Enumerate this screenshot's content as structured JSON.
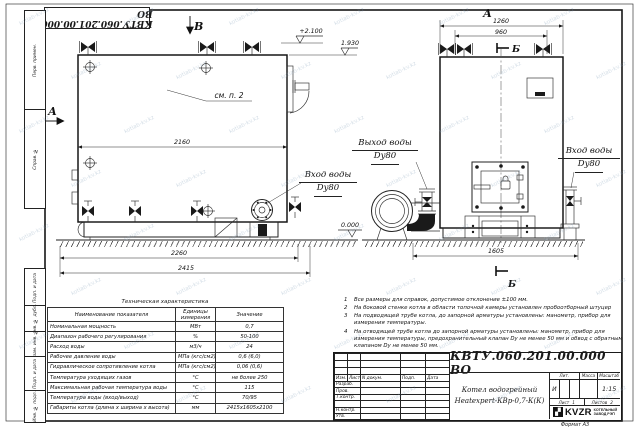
{
  "watermark": "kotlab-kv.kz",
  "corner_stamp": "КВТУ.060.201.00.000 ВО",
  "margin_labels": [
    "Перв. примен.",
    "Справ. №",
    "Подп. и дата",
    "Инв. № дубл.",
    "Взам. инв. №",
    "Подп. и дата",
    "Инв. № подл."
  ],
  "drawing": {
    "view_a_left": "А",
    "view_a_top": "А",
    "view_b": "В",
    "section_b_top": "Б",
    "section_b_bottom": "Б",
    "see_note": "см. п. 2",
    "dims": {
      "front_top": "2160",
      "front_mid": "2260",
      "front_total": "2415",
      "side_top": "1260",
      "side_inner": "960",
      "side_base": "1605"
    },
    "elevations": {
      "top": "+2.100",
      "flue": "1.930",
      "zero": "0.000"
    },
    "labels": {
      "outlet_title": "Выход воды",
      "outlet_dn": "Dy80",
      "inlet_side_title": "Вход воды",
      "inlet_side_dn": "Dy80",
      "inlet_front_title": "Вход воды",
      "inlet_front_dn": "Dy80"
    }
  },
  "tech_table": {
    "title": "Техническая характеристика",
    "headers": [
      "Наименование показателя",
      "Единицы измерения",
      "Значение"
    ],
    "rows": [
      [
        "Номинальная мощность",
        "МВт",
        "0,7"
      ],
      [
        "Диапазон рабочего регулирования",
        "%",
        "50-100"
      ],
      [
        "Расход воды",
        "м3/ч",
        "24"
      ],
      [
        "Рабочее давление воды",
        "МПа (кгс/см2)",
        "0,6 (6,0)"
      ],
      [
        "Гидравлическое сопротивление котла",
        "МПа (кгс/см2)",
        "0,06 (0,6)"
      ],
      [
        "Температура уходящих газов",
        "°С",
        "не более 250"
      ],
      [
        "Максимальная рабочая температура воды",
        "°С",
        "115"
      ],
      [
        "Температура воды (вход/выход)",
        "°С",
        "70/95"
      ],
      [
        "Габариты котла (длина х ширина х высота)",
        "мм",
        "2415х1605х2100"
      ]
    ]
  },
  "notes": [
    "Все размеры для справок, допустимое отклонение ±100 мм.",
    "На боковой стенке котла в области топочной камеры установлен пробоотборный штуцер",
    "На подводящей трубе котла, до запорной арматуры установлены: манометр, прибор для измерения температуры.",
    "На отводящей трубе котла до запорной арматуры установлены: манометр, прибор для измерения температуры, предохранительный клапан Dy не менее 50 мм и обвод с обратным клапаном Dy не менее 50 мм."
  ],
  "titleblock": {
    "doc_number": "КВТУ.060.201.00.000 ВО",
    "product_line1": "Котел водогрейный",
    "product_line2": "Heatexpert-КВр-0,7-К(К)",
    "rev_header": [
      "Изм.",
      "Лист",
      "N докум.",
      "Подп.",
      "Дата"
    ],
    "sign_rows": [
      "Разраб.",
      "Пров.",
      "Т.контр.",
      "",
      "Н.контр.",
      "Утв."
    ],
    "lit_label": "Лит.",
    "mass_label": "Масса",
    "scale_label": "Масштаб",
    "lit_value": "И",
    "scale_value": "1:15",
    "sheet_label": "Лист",
    "sheet_value": "1",
    "sheets_label": "Листов",
    "sheets_value": "2",
    "logo_glyph": "▞",
    "logo_text": "KVZR",
    "logo_sub1": "КОТЕЛЬНЫЙ",
    "logo_sub2": "ЗАВОД РЭП",
    "format_label": "Формат  А3"
  }
}
